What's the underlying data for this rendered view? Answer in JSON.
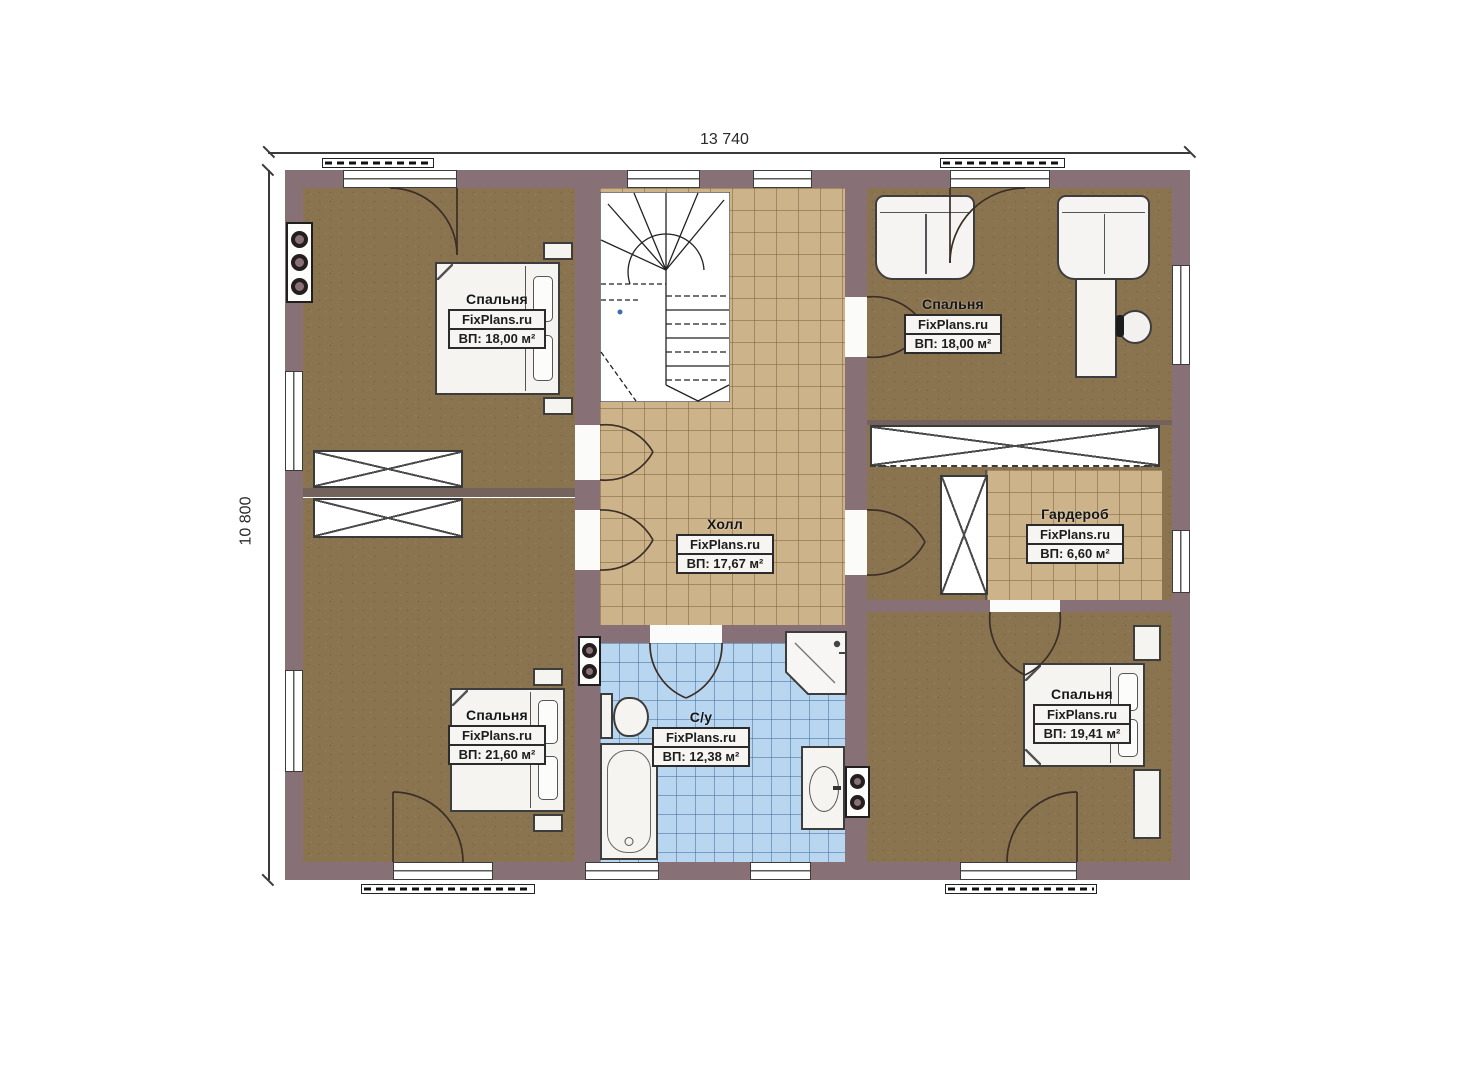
{
  "watermark": "FixPlans.ru",
  "dimensions": {
    "width": "13 740",
    "height": "10 800"
  },
  "rooms": {
    "bedroom_top_left": {
      "name": "Спальня",
      "brand": "FixPlans.ru",
      "area": "ВП: 18,00 м²"
    },
    "bedroom_top_right": {
      "name": "Спальня",
      "brand": "FixPlans.ru",
      "area": "ВП: 18,00 м²"
    },
    "hall": {
      "name": "Холл",
      "brand": "FixPlans.ru",
      "area": "ВП: 17,67 м²"
    },
    "wardrobe": {
      "name": "Гардероб",
      "brand": "FixPlans.ru",
      "area": "ВП: 6,60 м²"
    },
    "bedroom_bottom_left": {
      "name": "Спальня",
      "brand": "FixPlans.ru",
      "area": "ВП: 21,60 м²"
    },
    "bathroom": {
      "name": "С/у",
      "brand": "FixPlans.ru",
      "area": "ВП: 12,38 м²"
    },
    "bedroom_bottom_right": {
      "name": "Спальня",
      "brand": "FixPlans.ru",
      "area": "ВП: 19,41 м²"
    }
  },
  "colors": {
    "wall": "#877176",
    "floor": "#8a734f",
    "tile_hall": "#cdb38a",
    "tile_bath": "#b9d6f1"
  }
}
